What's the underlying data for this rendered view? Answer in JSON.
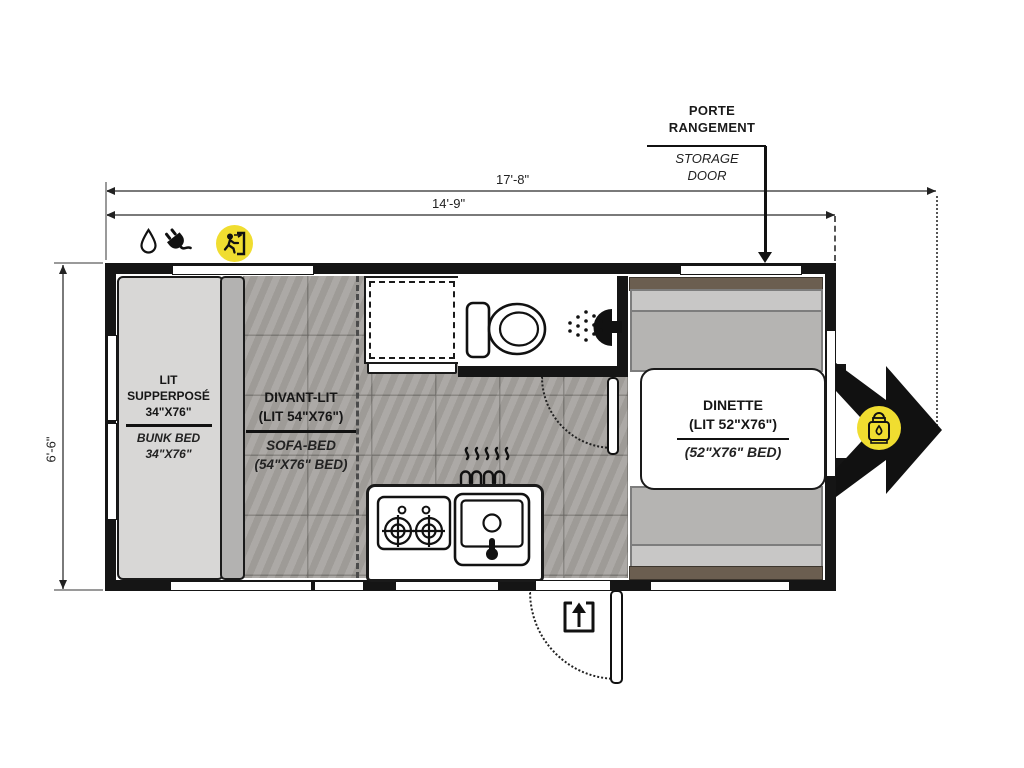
{
  "dimensions": {
    "overall_length": "17'-8\"",
    "box_length": "14'-9\"",
    "width": "6'-6\""
  },
  "storage_callout": {
    "fr_line1": "PORTE",
    "fr_line2": "RANGEMENT",
    "en_line1": "STORAGE",
    "en_line2": "DOOR"
  },
  "labels": {
    "bunk": {
      "fr_1": "LIT",
      "fr_2": "SUPPERPOSÉ",
      "fr_3": "34\"X76\"",
      "en_1": "BUNK BED",
      "en_2": "34\"X76\""
    },
    "sofa": {
      "fr_1": "DIVANT-LIT",
      "fr_2": "(LIT 54\"X76\")",
      "en_1": "SOFA-BED",
      "en_2": "(54\"X76\" BED)"
    },
    "dinette": {
      "fr_1": "DINETTE",
      "fr_2": "(LIT 52\"X76\")",
      "en_1": "(52\"X76\" BED)"
    }
  },
  "icons": {
    "water": "water-drop-icon",
    "power": "power-plug-icon",
    "exit": "emergency-exit-icon",
    "propane": "propane-tank-icon",
    "entry": "entry-door-icon",
    "heater": "furnace-icon",
    "toilet": "toilet-icon",
    "shower": "shower-head-icon",
    "stove": "stove-burners-icon",
    "sink": "sink-icon"
  },
  "colors": {
    "accent_yellow": "#f0dd30",
    "wall_black": "#151515",
    "tile_gray": "#a6a39f",
    "bench_gray": "#b5b4b2",
    "wood_brown": "#6b5e50",
    "bed_gray": "#d8d7d6"
  }
}
